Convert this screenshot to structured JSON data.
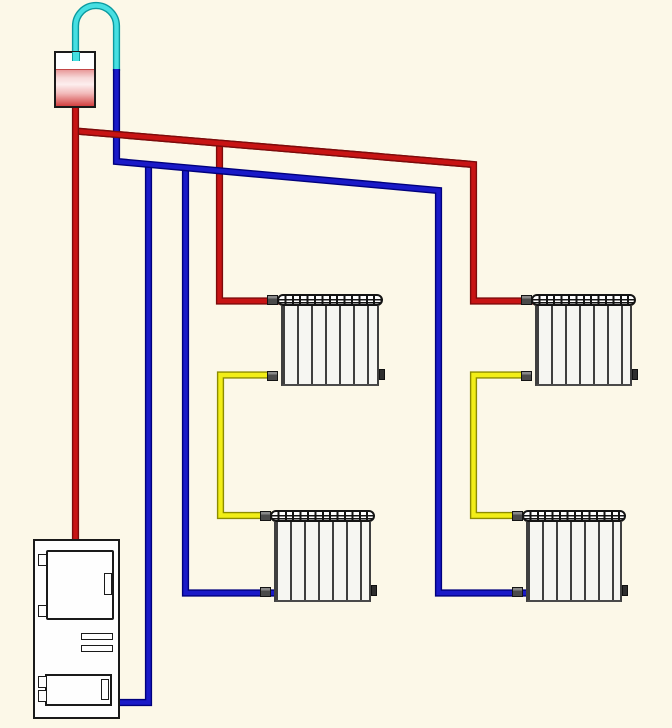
{
  "canvas": {
    "width": 672,
    "height": 728,
    "background": "#fcf8e8"
  },
  "diagram": {
    "kind": "two-pipe-gravity-heating-system-schematic",
    "palette": {
      "supply": {
        "core": "#c81414",
        "casing": "#7d0b0b"
      },
      "return": {
        "core": "#1a1ac8",
        "casing": "#00007d"
      },
      "link": {
        "core": "#f2ee17",
        "casing": "#8c8c00"
      },
      "expansion": {
        "core": "#46dfe2",
        "casing": "#0b9aa0"
      }
    },
    "components": {
      "expansion_tank": {
        "x": 54,
        "y": 51,
        "w": 42,
        "h": 57
      },
      "boiler": {
        "x": 33,
        "y": 539,
        "w": 87,
        "h": 180
      },
      "radiators": [
        {
          "label": "radiator-top-left",
          "x": 277,
          "y": 294,
          "w": 106,
          "h": 92
        },
        {
          "label": "radiator-top-right",
          "x": 531,
          "y": 294,
          "w": 105,
          "h": 92
        },
        {
          "label": "radiator-bottom-left",
          "x": 270,
          "y": 510,
          "w": 105,
          "h": 92
        },
        {
          "label": "radiator-bottom-right",
          "x": 522,
          "y": 510,
          "w": 104,
          "h": 92
        }
      ]
    },
    "pipes": [
      {
        "name": "expansion-loop-pipe",
        "color": "expansion",
        "d": "M 75.5 52 L 75.5 26 A 20.5 20.5 0 0 1 116.5 26 L 116.5 71"
      },
      {
        "name": "supply-branch-left",
        "color": "supply",
        "d": "M 219.5 143 L 219.5 301 L 283 301"
      },
      {
        "name": "supply-header",
        "color": "supply",
        "d": "M 75.5 131 L 473.5 164.5 L 473.5 301 L 537 301"
      },
      {
        "name": "supply-riser",
        "color": "supply",
        "d": "M 75.5 106 L 75.5 541"
      },
      {
        "name": "link-left-column",
        "color": "link",
        "d": "M 274 375 L 220.5 375 L 220.5 515.5 L 276 515.5"
      },
      {
        "name": "link-right-column",
        "color": "link",
        "d": "M 527 375 L 473.5 375 L 473.5 515.5 L 528 515.5"
      },
      {
        "name": "return-to-boiler",
        "color": "return",
        "d": "M 148.5 164 L 148.5 702.5 L 119 702.5"
      },
      {
        "name": "return-left-column",
        "color": "return",
        "d": "M 185.5 167 L 185.5 593 L 276 593"
      },
      {
        "name": "return-header",
        "color": "return",
        "d": "M 116.5 69 L 116.5 161.5 L 438.5 190.5 L 438.5 593 L 528 593"
      },
      {
        "name": "supply-header-overpass",
        "color": "supply",
        "d": "M 80 131.4 L 470 164.2"
      }
    ]
  }
}
